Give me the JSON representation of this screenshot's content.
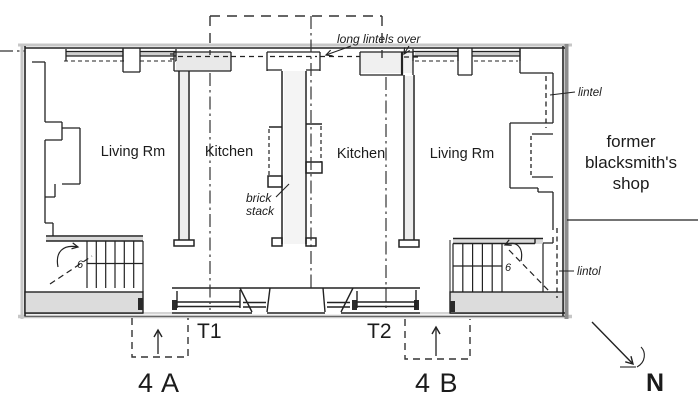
{
  "colors": {
    "ink": "#1f1f1f",
    "pencil": "#c7c7c7",
    "wall_shadow": "#8d8d8d",
    "wall_fill": "#dcdcdc",
    "paper": "#ffffff"
  },
  "rooms": {
    "unit_a_living": "Living Rm",
    "unit_a_kitchen": "Kitchen",
    "unit_b_kitchen": "Kitchen",
    "unit_b_living": "Living Rm"
  },
  "adjacent_building": {
    "line1": "former",
    "line2": "blacksmith's",
    "line3": "shop"
  },
  "annotations": {
    "long_lintels": "long lintels over",
    "lintel_rear": "lintel",
    "brick_line1": "brick",
    "brick_line2": "stack",
    "lintel_front": "lintol"
  },
  "section_markers": {
    "t1": "T1",
    "t2": "T2"
  },
  "unit_labels": {
    "a": "4 A",
    "b": "4 B"
  },
  "stair_risers": {
    "unit_a": "6",
    "unit_b": "6"
  },
  "compass": {
    "north": "N"
  }
}
